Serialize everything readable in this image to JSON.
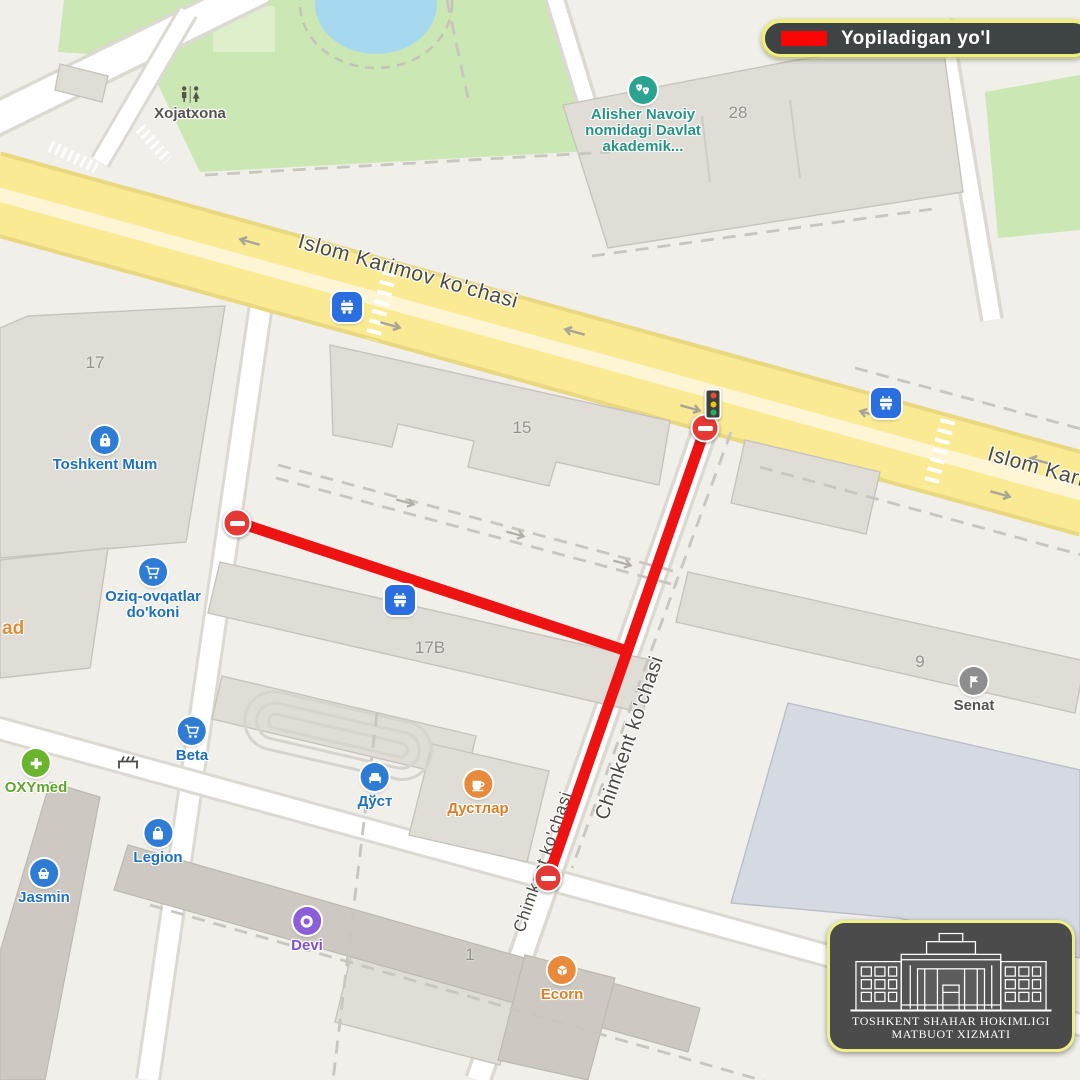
{
  "legend": {
    "label": "Yopiladigan yo'l",
    "swatch": "closed-road-red-line"
  },
  "colors": {
    "closure_red": "#ee1313",
    "legend_border": "#eeef7d",
    "road_yellow": "#f9ea93",
    "poi_blue": "#2e7cd4",
    "poi_teal": "#2aa390",
    "poi_green": "#6ab42e",
    "poi_orange": "#e8893b",
    "poi_purple": "#8a5fd8",
    "poi_gray": "#8e8e8e"
  },
  "roads": {
    "islom_karimov": {
      "label": "Islom Karimov ko'chasi"
    },
    "chimkent": {
      "label": "Chimkent ko'chasi"
    }
  },
  "building_numbers": {
    "b17": "17",
    "b15": "15",
    "b17b": "17B",
    "b28": "28",
    "b9": "9",
    "b1": "1"
  },
  "pois": {
    "xojatxona": {
      "label": "Xojatxona",
      "icon": "toilets-icon"
    },
    "alisher": {
      "line1": "Alisher Navoiy",
      "line2": "nomidagi Davlat",
      "line3": "akademik...",
      "icon": "theater-masks-icon"
    },
    "toshkent_mum": {
      "label": "Toshkent Mum",
      "icon": "shopping-bag-icon"
    },
    "oziq": {
      "line1": "Oziq-ovqatlar",
      "line2": "do'koni",
      "icon": "shopping-cart-icon"
    },
    "beta": {
      "label": "Beta",
      "icon": "shopping-cart-icon"
    },
    "oxymed": {
      "label": "OXYmed",
      "icon": "medical-cross-icon"
    },
    "dost": {
      "label": "Дўст",
      "icon": "sofa-icon"
    },
    "dustlar": {
      "label": "Дустлар",
      "icon": "coffee-cup-icon"
    },
    "legion": {
      "label": "Legion",
      "icon": "shopping-bag-icon"
    },
    "jasmin": {
      "label": "Jasmin",
      "icon": "basket-icon"
    },
    "devi": {
      "label": "Devi",
      "icon": "ring-icon"
    },
    "ecorn": {
      "label": "Ecorn",
      "icon": "box-icon"
    },
    "senat": {
      "label": "Senat",
      "icon": "flag-icon"
    },
    "left_truncated": {
      "label": "ad"
    }
  },
  "badge": {
    "line1": "TOSHKENT SHAHAR HOKIMLIGI",
    "line2": "MATBUOT XIZMATI"
  }
}
